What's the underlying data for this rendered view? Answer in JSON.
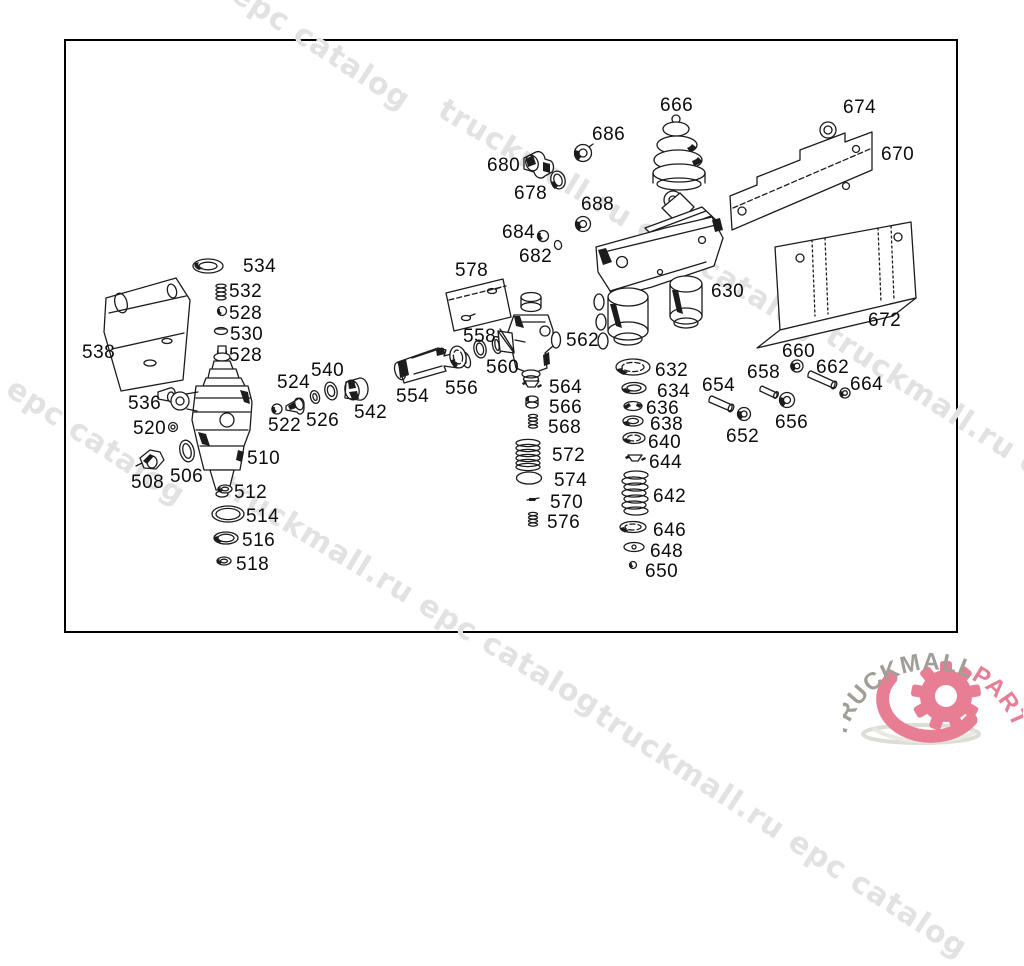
{
  "diagram": {
    "type": "exploded-parts-diagram",
    "border_color": "#000000",
    "line_color": "#1c1c1c",
    "watermark_text": "truckmall.ru epc catalog",
    "watermark_color": "#e2e2e2",
    "watermarks": [
      {
        "x": 50,
        "y": -150,
        "rot": 33
      },
      {
        "x": 450,
        "y": 92,
        "rot": 31
      },
      {
        "x": -175,
        "y": 245,
        "rot": 33
      },
      {
        "x": 232,
        "y": 468,
        "rot": 31
      },
      {
        "x": 838,
        "y": 318,
        "rot": 33
      },
      {
        "x": 607,
        "y": 698,
        "rot": 33
      }
    ],
    "parts": [
      {
        "label": "666",
        "x": 660,
        "y": 95
      },
      {
        "label": "674",
        "x": 843,
        "y": 97
      },
      {
        "label": "686",
        "x": 592,
        "y": 124
      },
      {
        "label": "680",
        "x": 487,
        "y": 155
      },
      {
        "label": "678",
        "x": 514,
        "y": 183
      },
      {
        "label": "670",
        "x": 881,
        "y": 144
      },
      {
        "label": "688",
        "x": 581,
        "y": 194
      },
      {
        "label": "684",
        "x": 502,
        "y": 222
      },
      {
        "label": "682",
        "x": 519,
        "y": 246
      },
      {
        "label": "630",
        "x": 711,
        "y": 281
      },
      {
        "label": "672",
        "x": 868,
        "y": 310
      },
      {
        "label": "578",
        "x": 455,
        "y": 260
      },
      {
        "label": "534",
        "x": 243,
        "y": 256
      },
      {
        "label": "532",
        "x": 229,
        "y": 281
      },
      {
        "label": "528",
        "x": 229,
        "y": 303
      },
      {
        "label": "530",
        "x": 230,
        "y": 324
      },
      {
        "label": "528",
        "x": 229,
        "y": 345
      },
      {
        "label": "538",
        "x": 82,
        "y": 342
      },
      {
        "label": "536",
        "x": 128,
        "y": 393
      },
      {
        "label": "520",
        "x": 133,
        "y": 418
      },
      {
        "label": "508",
        "x": 131,
        "y": 472
      },
      {
        "label": "506",
        "x": 170,
        "y": 466
      },
      {
        "label": "510",
        "x": 247,
        "y": 448
      },
      {
        "label": "512",
        "x": 234,
        "y": 482
      },
      {
        "label": "514",
        "x": 246,
        "y": 506
      },
      {
        "label": "516",
        "x": 242,
        "y": 530
      },
      {
        "label": "518",
        "x": 236,
        "y": 554
      },
      {
        "label": "522",
        "x": 268,
        "y": 415
      },
      {
        "label": "524",
        "x": 277,
        "y": 372
      },
      {
        "label": "526",
        "x": 306,
        "y": 410
      },
      {
        "label": "540",
        "x": 311,
        "y": 360
      },
      {
        "label": "542",
        "x": 354,
        "y": 402
      },
      {
        "label": "554",
        "x": 396,
        "y": 386
      },
      {
        "label": "556",
        "x": 445,
        "y": 378
      },
      {
        "label": "558",
        "x": 463,
        "y": 326
      },
      {
        "label": "560",
        "x": 486,
        "y": 357
      },
      {
        "label": "562",
        "x": 566,
        "y": 330
      },
      {
        "label": "564",
        "x": 549,
        "y": 377
      },
      {
        "label": "566",
        "x": 549,
        "y": 397
      },
      {
        "label": "568",
        "x": 548,
        "y": 417
      },
      {
        "label": "572",
        "x": 552,
        "y": 445
      },
      {
        "label": "574",
        "x": 554,
        "y": 470
      },
      {
        "label": "570",
        "x": 550,
        "y": 492
      },
      {
        "label": "576",
        "x": 547,
        "y": 512
      },
      {
        "label": "632",
        "x": 655,
        "y": 360
      },
      {
        "label": "634",
        "x": 657,
        "y": 381
      },
      {
        "label": "636",
        "x": 646,
        "y": 398
      },
      {
        "label": "638",
        "x": 650,
        "y": 414
      },
      {
        "label": "640",
        "x": 648,
        "y": 432
      },
      {
        "label": "644",
        "x": 649,
        "y": 452
      },
      {
        "label": "642",
        "x": 653,
        "y": 486
      },
      {
        "label": "646",
        "x": 653,
        "y": 520
      },
      {
        "label": "648",
        "x": 650,
        "y": 541
      },
      {
        "label": "650",
        "x": 645,
        "y": 561
      },
      {
        "label": "660",
        "x": 782,
        "y": 341
      },
      {
        "label": "662",
        "x": 816,
        "y": 357
      },
      {
        "label": "664",
        "x": 850,
        "y": 374
      },
      {
        "label": "658",
        "x": 747,
        "y": 362
      },
      {
        "label": "654",
        "x": 702,
        "y": 375
      },
      {
        "label": "656",
        "x": 775,
        "y": 412
      },
      {
        "label": "652",
        "x": 726,
        "y": 426
      }
    ]
  },
  "logo": {
    "text_gray": "TRUCKMALL",
    "text_pink": "PARTS",
    "color_gray": "#a09e96",
    "color_pink": "#e87e94",
    "swoosh_gray": "#deddd5"
  }
}
